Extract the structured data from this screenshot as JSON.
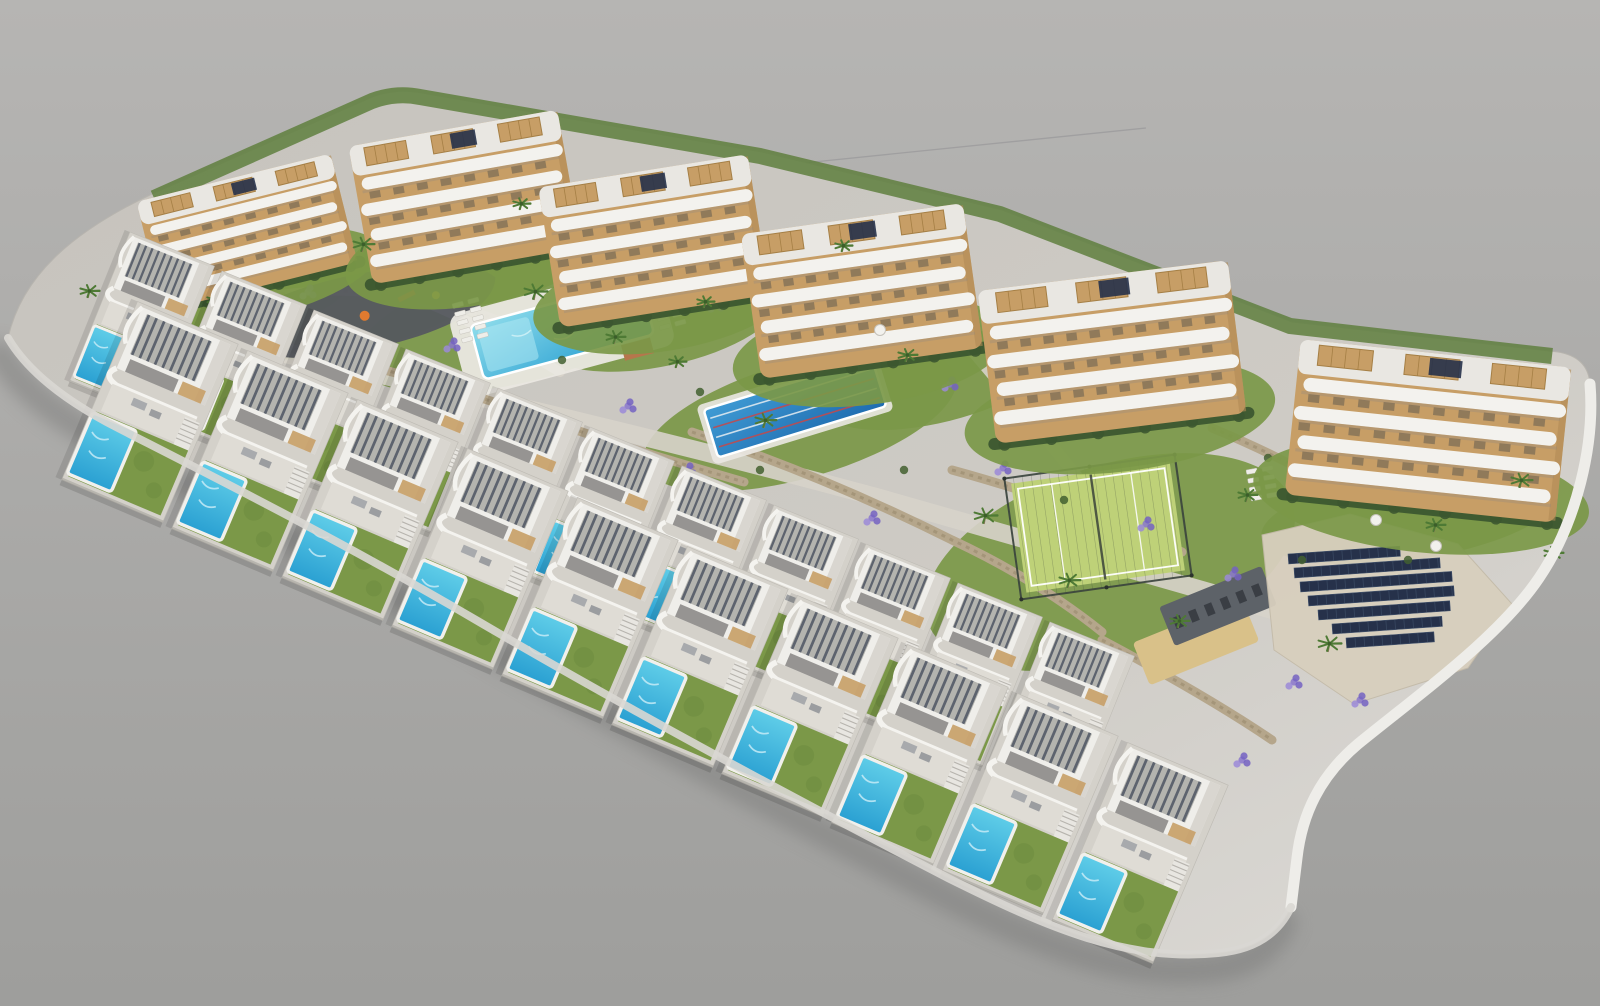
{
  "title": "aerial-3d-render-residential-resort",
  "canvas": {
    "width": 1600,
    "height": 1006
  },
  "palette": {
    "bg_top": "#b6b5b3",
    "bg_bottom": "#9e9e9c",
    "seam": "#98989a",
    "platform": "#cac7c1",
    "platform_light": "#dcdad6",
    "wall_white": "#eeede9",
    "wall_light": "#d9d7d3",
    "shadow": "#7c7c7a",
    "lawn": "#7b9848",
    "lawn_dark": "#6c8a3d",
    "hedge": "#3c5730",
    "hedge_line": "#5f7f3e",
    "stone": "#b5a68b",
    "stone_dark": "#998a6e",
    "road": "#d7d3ca",
    "asphalt": "#55595f",
    "pool_light": "#8edceb",
    "pool_mid": "#49c0e2",
    "pool_deep": "#2aa0d2",
    "lap_light": "#3f9bd4",
    "lap_deep": "#1f6cb0",
    "lane_red": "#c84848",
    "lane_white": "#e8eef2",
    "deck_white": "#eae8e2",
    "lounger": "#efeee9",
    "tan": "#c79e66",
    "tan_dark": "#a57f45",
    "white": "#f3f2ee",
    "side": "#b08a55",
    "slat": "#5d636e",
    "roofdeck": "#e9e7e2",
    "window": "#59554d",
    "pv": "#26314a",
    "sand": "#d9c189",
    "gym": "#5d6268",
    "gym_dark": "#3a3e44",
    "padel": "#bed178",
    "padel_line": "#ffffff",
    "fence": "#39423c",
    "palm": "#4e7a35",
    "palm_dark": "#3c5e2a",
    "trunk": "#8a7a58",
    "shrub": "#436030",
    "lav1": "#8a77cc",
    "lav2": "#7463c2",
    "lav3": "#9b8ad8",
    "villa_base": "#d4d1ca",
    "villa_terrace": "#dfdcd5",
    "house_roof": "#b4b4af",
    "pool_house_roof": "#b6764c"
  },
  "background": {
    "seam_line": {
      "x1": 618,
      "y1": 182,
      "x2": 1146,
      "y2": 128
    }
  },
  "platform": {
    "outline": "M 8 338 C 22 276 72 232 152 194 L 372 97 Q 396 88 422 93 L 762 152 L 1002 210 L 1292 322 L 1558 352 Q 1588 357 1590 384 C 1595 444 1577 522 1539 578 C 1500 636 1422 692 1358 744 C 1320 776 1302 814 1297 858 L 1291 907 Q 1272 948 1218 953 C 1128 962 1050 929 948 878 C 816 810 636 714 476 620 C 336 538 204 472 118 428 Q 36 386 8 338 Z",
    "right_wall": "M 1590 384 C 1595 444 1577 522 1539 578 C 1500 636 1422 692 1358 744 C 1320 776 1302 814 1297 858 L 1291 907",
    "bottom_wall": "M 1291 907 Q 1272 948 1218 953 C 1128 962 1050 929 948 878 C 816 810 636 714 476 620 C 336 538 204 472 118 428 Q 36 386 8 338",
    "top_hedge": "M 154 198 L 372 101 Q 396 92 420 97 L 760 156 L 1000 214 L 1290 326 L 1552 356"
  },
  "lawns": [
    {
      "cx": 244,
      "cy": 296,
      "rx": 112,
      "ry": 40,
      "rot": -12
    },
    {
      "cx": 348,
      "cy": 306,
      "rx": 140,
      "ry": 46,
      "rot": -12
    },
    {
      "cx": 520,
      "cy": 322,
      "rx": 168,
      "ry": 60,
      "rot": -14
    },
    {
      "cx": 662,
      "cy": 322,
      "rx": 120,
      "ry": 44,
      "rot": -12
    },
    {
      "cx": 800,
      "cy": 420,
      "rx": 162,
      "ry": 58,
      "rot": -16
    },
    {
      "cx": 940,
      "cy": 380,
      "rx": 120,
      "ry": 42,
      "rot": -14
    },
    {
      "cx": 1110,
      "cy": 562,
      "rx": 192,
      "ry": 96,
      "rot": -18
    },
    {
      "cx": 1408,
      "cy": 516,
      "rx": 148,
      "ry": 44,
      "rot": -8
    }
  ],
  "roads": [
    {
      "d": "M 112 318 C 380 372 620 428 880 498 C 1060 548 1205 590 1335 628",
      "w": 18
    },
    {
      "d": "M 960 336 C 1006 390 1046 438 1078 478",
      "w": 12
    },
    {
      "d": "M 420 300 C 470 320 520 348 560 372",
      "w": 10
    }
  ],
  "stone_walls": [
    {
      "d": "M 214 336 C 340 352 470 392 576 430 C 652 456 704 470 744 482"
    },
    {
      "d": "M 692 432 C 782 462 872 500 952 540 C 1012 568 1062 600 1102 632"
    },
    {
      "d": "M 952 470 C 1032 492 1112 520 1182 552"
    },
    {
      "d": "M 1102 640 C 1162 672 1222 706 1272 740"
    },
    {
      "d": "M 246 302 C 306 282 424 290 502 322"
    },
    {
      "d": "M 1212 428 C 1260 448 1304 470 1340 492"
    }
  ],
  "playground": {
    "x": 372,
    "y": 312,
    "rot": -13,
    "items": [
      {
        "t": "bar",
        "x": -60,
        "y": -8,
        "w": 26,
        "h": 6,
        "c": "#e8b33a",
        "r": 18
      },
      {
        "t": "dot",
        "x": -8,
        "y": 2,
        "rad": 5,
        "c": "#e07a2f"
      },
      {
        "t": "bar",
        "x": 28,
        "y": -8,
        "w": 18,
        "h": 5,
        "c": "#cf4a3a",
        "r": -14
      },
      {
        "t": "dot",
        "x": 66,
        "y": -2,
        "rad": 4,
        "c": "#e8b33a"
      },
      {
        "t": "bar",
        "x": -96,
        "y": -14,
        "w": 14,
        "h": 5,
        "c": "#e8b33a",
        "r": 30
      }
    ]
  },
  "communal_pool": {
    "x": 562,
    "y": 330,
    "rot": -15,
    "deck_w": 214,
    "deck_h": 86,
    "w": 176,
    "h": 56
  },
  "pool_house": {
    "x": 630,
    "y": 368,
    "rot": -15,
    "w": 30,
    "h": 16
  },
  "lap_pool": {
    "x": 795,
    "y": 408,
    "rot": -17,
    "w": 176,
    "h": 50,
    "lanes": 4
  },
  "padel_court": {
    "x": 1098,
    "y": 527,
    "rot": -8,
    "w": 160,
    "h": 110
  },
  "gym_deck": {
    "x": 1218,
    "y": 606,
    "rot": -22,
    "w": 110,
    "h": 42
  },
  "sand_court": {
    "x": 1196,
    "y": 642,
    "rot": -22,
    "w": 118,
    "h": 46
  },
  "solar_field": {
    "pavement": "M 1262 535 L 1350 514 L 1458 544 L 1512 604 L 1468 668 L 1354 704 L 1274 650 Z",
    "rot": -4,
    "rows": [
      [
        1288,
        554,
        112
      ],
      [
        1294,
        568,
        146
      ],
      [
        1300,
        582,
        152
      ],
      [
        1308,
        596,
        146
      ],
      [
        1318,
        610,
        132
      ],
      [
        1332,
        624,
        110
      ],
      [
        1346,
        638,
        88
      ]
    ]
  },
  "lounger_clusters": [
    {
      "x": 452,
      "y": 304,
      "rot": -15,
      "cols": 2,
      "rows": 5
    },
    {
      "x": 560,
      "y": 278,
      "rot": -15,
      "cols": 2,
      "rows": 4
    },
    {
      "x": 652,
      "y": 300,
      "rot": -15,
      "cols": 2,
      "rows": 4
    },
    {
      "x": 1246,
      "y": 470,
      "rot": -10,
      "cols": 2,
      "rows": 4
    }
  ],
  "apartment_blocks": [
    {
      "x": 247,
      "y": 232,
      "w": 200,
      "h": 112,
      "rot": -14
    },
    {
      "x": 465,
      "y": 197,
      "w": 212,
      "h": 140,
      "rot": -10
    },
    {
      "x": 654,
      "y": 241,
      "w": 212,
      "h": 142,
      "rot": -9
    },
    {
      "x": 862,
      "y": 291,
      "w": 224,
      "h": 146,
      "rot": -8
    },
    {
      "x": 1112,
      "y": 352,
      "w": 252,
      "h": 154,
      "rot": -7
    },
    {
      "x": 1428,
      "y": 431,
      "w": 272,
      "h": 156,
      "rot": 6
    }
  ],
  "villa_rows": [
    {
      "name": "upper-villa-row",
      "rot": 22,
      "scale": 0.95,
      "villas": [
        {
          "x": 142,
          "y": 324
        },
        {
          "x": 234,
          "y": 363
        },
        {
          "x": 326,
          "y": 402
        },
        {
          "x": 418,
          "y": 441
        },
        {
          "x": 510,
          "y": 480
        },
        {
          "x": 602,
          "y": 519
        },
        {
          "x": 694,
          "y": 558
        },
        {
          "x": 786,
          "y": 597
        },
        {
          "x": 878,
          "y": 636
        },
        {
          "x": 970,
          "y": 675
        },
        {
          "x": 1062,
          "y": 714
        }
      ]
    },
    {
      "name": "lower-villa-row",
      "rot": 23,
      "scale": 1.14,
      "villas": [
        {
          "x": 150,
          "y": 412
        },
        {
          "x": 260,
          "y": 461
        },
        {
          "x": 370,
          "y": 510
        },
        {
          "x": 480,
          "y": 559
        },
        {
          "x": 590,
          "y": 608
        },
        {
          "x": 700,
          "y": 657
        },
        {
          "x": 810,
          "y": 706
        },
        {
          "x": 920,
          "y": 755
        },
        {
          "x": 1030,
          "y": 804
        },
        {
          "x": 1140,
          "y": 853
        }
      ]
    }
  ],
  "palms": [
    [
      88,
      298,
      10
    ],
    [
      214,
      306,
      9
    ],
    [
      362,
      252,
      11
    ],
    [
      534,
      300,
      12
    ],
    [
      614,
      344,
      10
    ],
    [
      704,
      308,
      9
    ],
    [
      764,
      428,
      11
    ],
    [
      906,
      362,
      10
    ],
    [
      842,
      252,
      9
    ],
    [
      984,
      524,
      12
    ],
    [
      1068,
      588,
      11
    ],
    [
      1178,
      628,
      10
    ],
    [
      1246,
      502,
      10
    ],
    [
      1328,
      652,
      12
    ],
    [
      1434,
      532,
      10
    ],
    [
      1520,
      488,
      11
    ],
    [
      1552,
      560,
      10
    ],
    [
      676,
      368,
      9
    ],
    [
      520,
      210,
      9
    ]
  ],
  "lavender": [
    [
      176,
      282
    ],
    [
      308,
      292
    ],
    [
      452,
      345
    ],
    [
      628,
      406
    ],
    [
      716,
      305
    ],
    [
      823,
      344
    ],
    [
      950,
      384
    ],
    [
      1003,
      468
    ],
    [
      1146,
      524
    ],
    [
      1233,
      574
    ],
    [
      1294,
      682
    ],
    [
      1242,
      760
    ],
    [
      1446,
      478
    ],
    [
      556,
      252
    ],
    [
      688,
      470
    ],
    [
      872,
      518
    ],
    [
      1360,
      700
    ],
    [
      1180,
      418
    ]
  ],
  "shrubs": [
    [
      180,
      250
    ],
    [
      330,
      220
    ],
    [
      470,
      160
    ],
    [
      600,
      200
    ],
    [
      730,
      240
    ],
    [
      860,
      300
    ],
    [
      1010,
      340
    ],
    [
      1140,
      400
    ],
    [
      1268,
      458
    ],
    [
      1488,
      420
    ],
    [
      232,
      330
    ],
    [
      562,
      360
    ],
    [
      700,
      392
    ],
    [
      904,
      470
    ],
    [
      1064,
      500
    ],
    [
      1408,
      560
    ],
    [
      1302,
      560
    ],
    [
      760,
      470
    ]
  ],
  "parasols": [
    [
      1376,
      520
    ],
    [
      1436,
      546
    ],
    [
      880,
      330
    ]
  ]
}
